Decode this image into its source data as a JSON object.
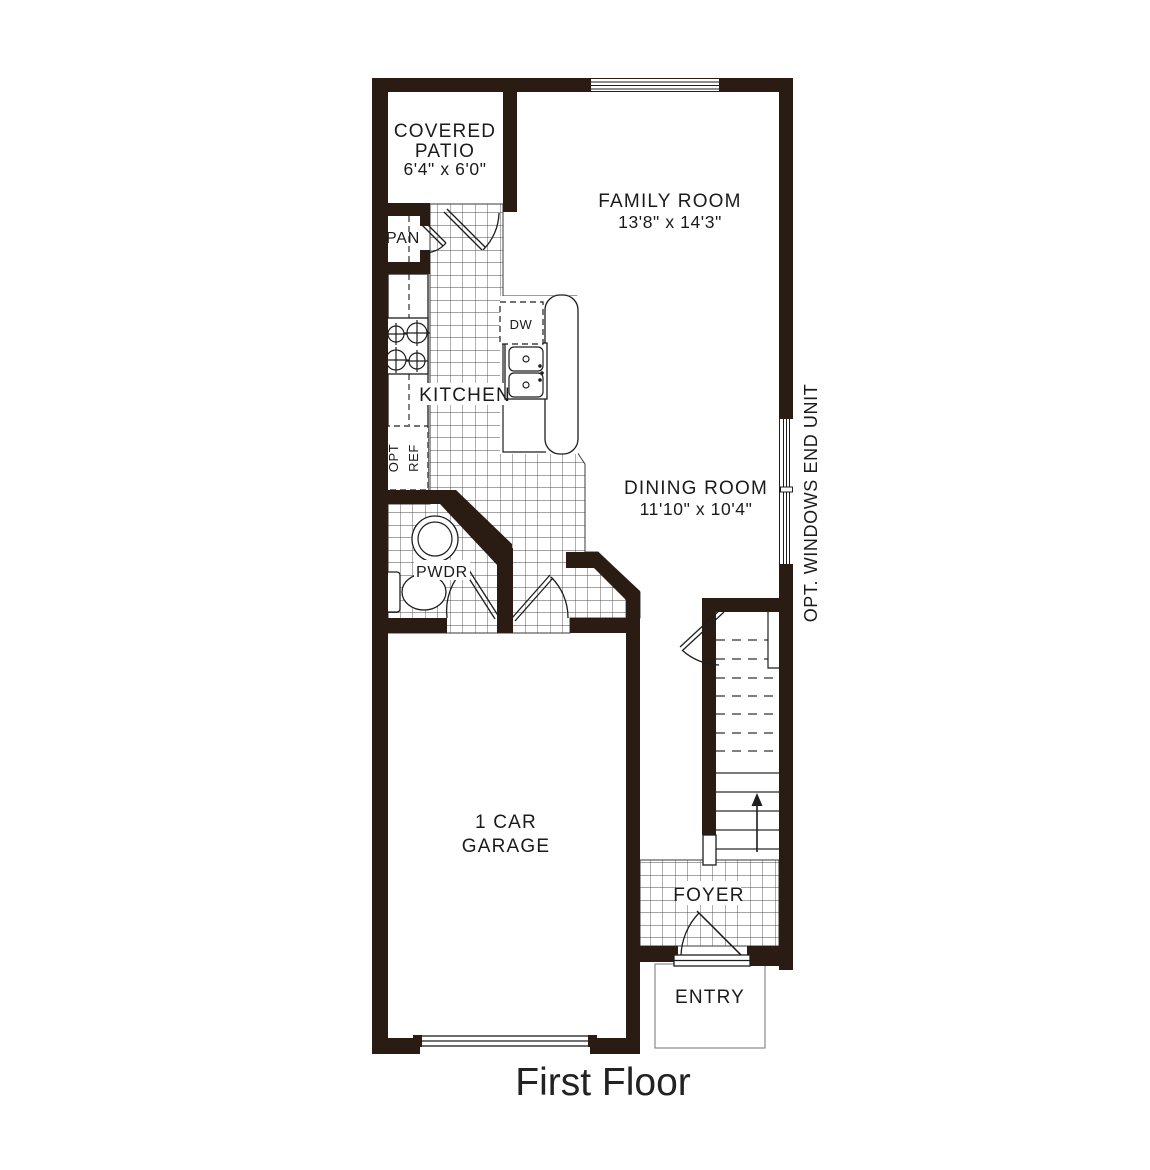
{
  "title": "First Floor",
  "plan": {
    "rooms": {
      "covered_patio": {
        "name_line1": "COVERED",
        "name_line2": "PATIO",
        "dims": "6'4\" x 6'0\""
      },
      "family_room": {
        "name": "FAMILY ROOM",
        "dims": "13'8\" x 14'3\""
      },
      "dining_room": {
        "name": "DINING ROOM",
        "dims": "11'10\" x 10'4\""
      },
      "kitchen": {
        "name": "KITCHEN"
      },
      "pantry": {
        "name": "PAN"
      },
      "powder_room": {
        "name": "PWDR"
      },
      "garage": {
        "name_line1": "1 CAR",
        "name_line2": "GARAGE"
      },
      "foyer": {
        "name": "FOYER"
      },
      "entry": {
        "name": "ENTRY"
      }
    },
    "fixtures": {
      "dishwasher": "DW",
      "opt_refrigerator_line1": "OPT",
      "opt_refrigerator_line2": "REF"
    },
    "note": "OPT. WINDOWS END UNIT",
    "colors": {
      "wall": "#2a1c13",
      "line": "#1d1d1d",
      "tile_line": "#4a4a4a",
      "floor": "#ffffff"
    }
  }
}
